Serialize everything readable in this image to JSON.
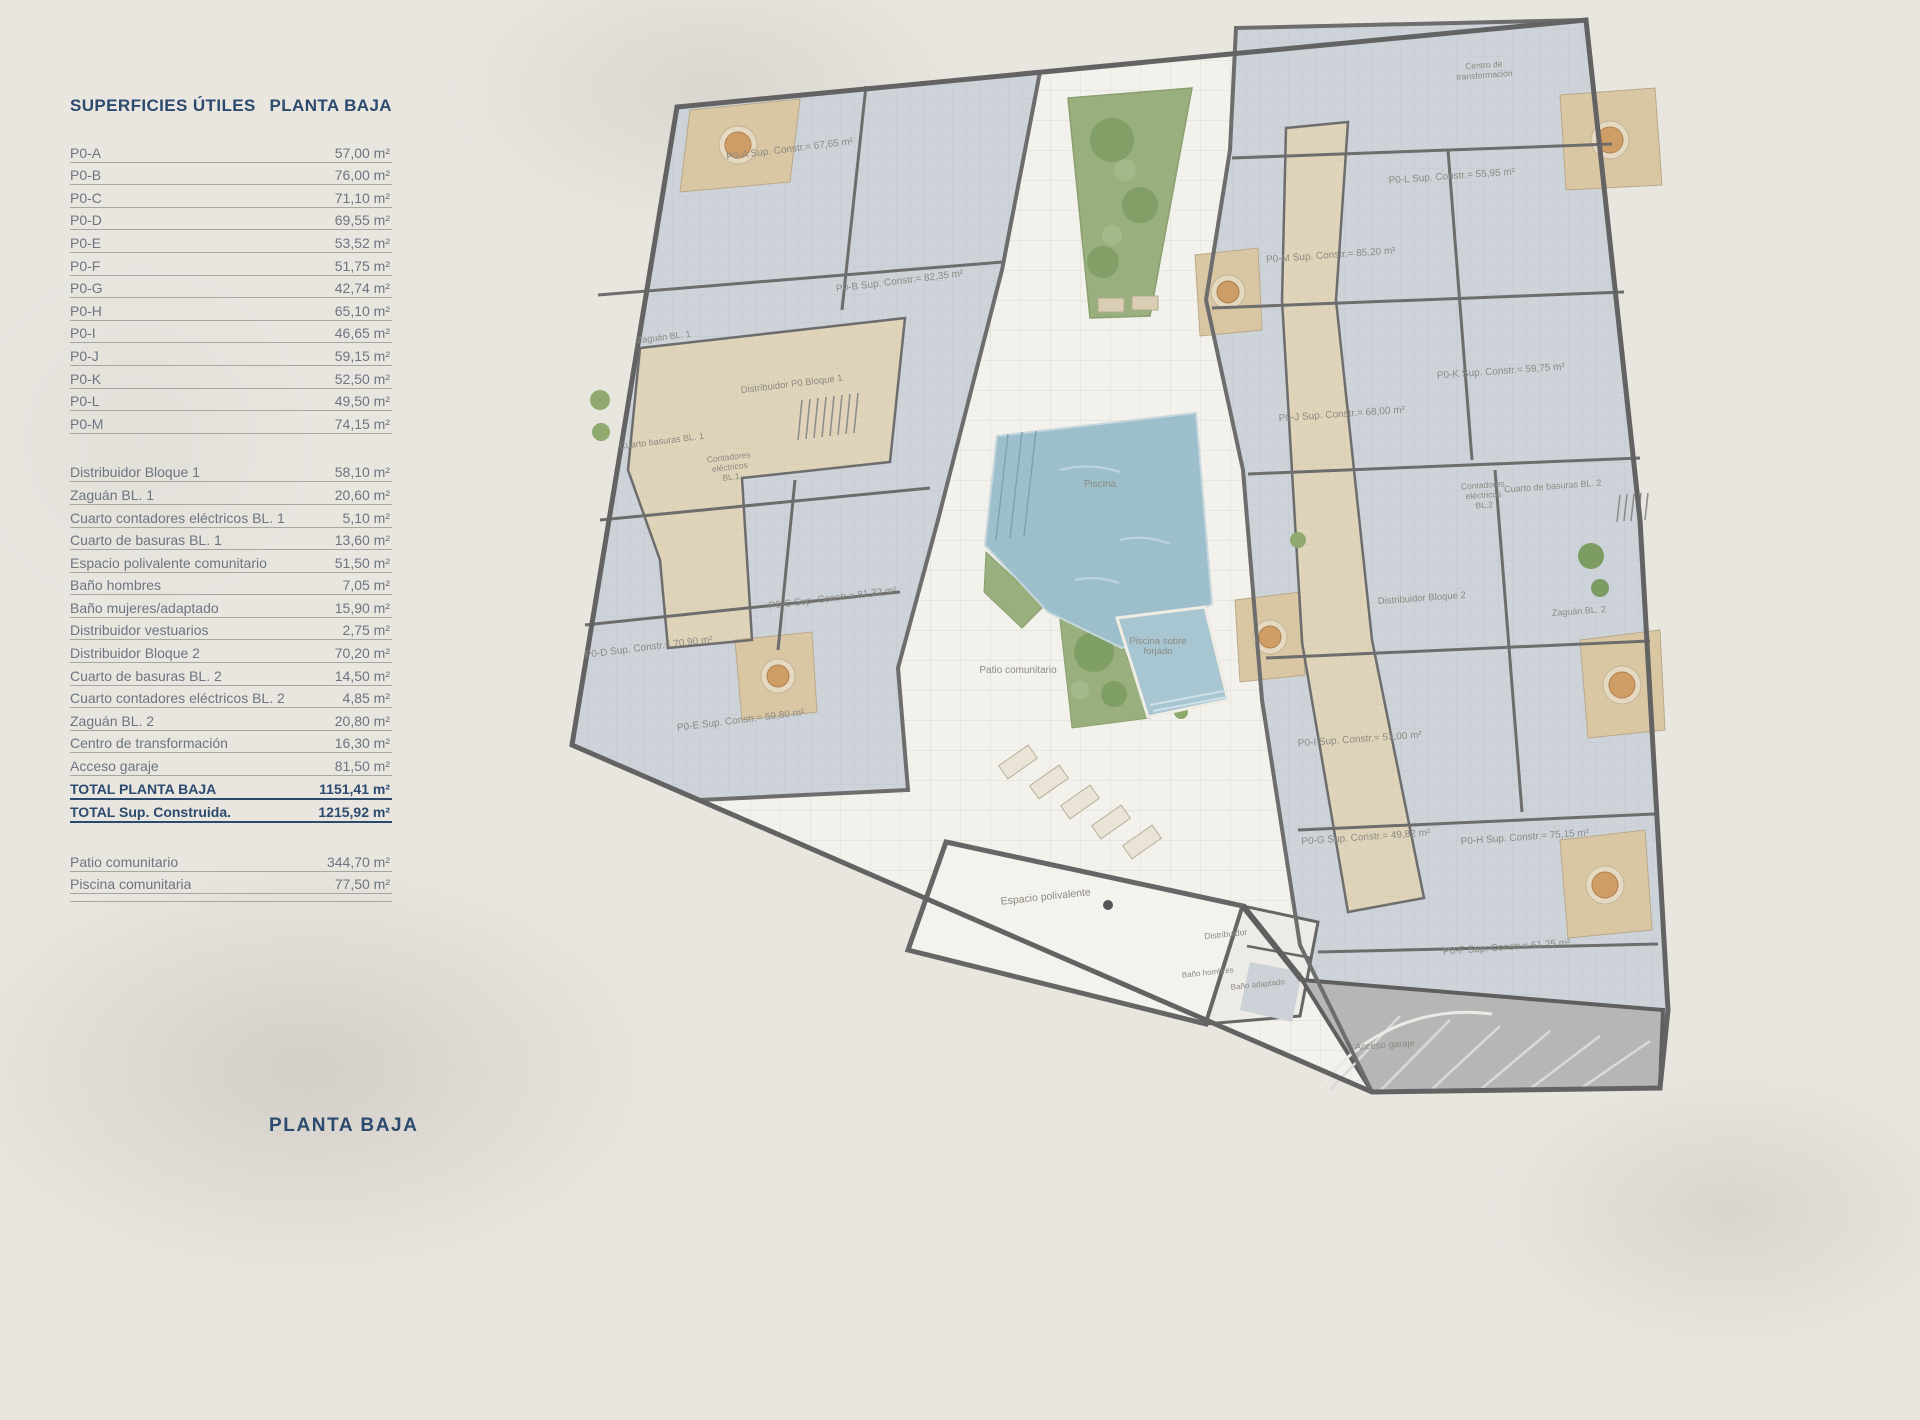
{
  "panel": {
    "title_left": "SUPERFICIES ÚTILES",
    "title_right": "PLANTA BAJA",
    "units": [
      {
        "label": "P0-A",
        "value": "57,00 m²"
      },
      {
        "label": "P0-B",
        "value": "76,00 m²"
      },
      {
        "label": "P0-C",
        "value": "71,10 m²"
      },
      {
        "label": "P0-D",
        "value": "69,55 m²"
      },
      {
        "label": "P0-E",
        "value": "53,52 m²"
      },
      {
        "label": "P0-F",
        "value": "51,75 m²"
      },
      {
        "label": "P0-G",
        "value": "42,74 m²"
      },
      {
        "label": "P0-H",
        "value": "65,10 m²"
      },
      {
        "label": "P0-I",
        "value": "46,65 m²"
      },
      {
        "label": "P0-J",
        "value": "59,15 m²"
      },
      {
        "label": "P0-K",
        "value": "52,50 m²"
      },
      {
        "label": "P0-L",
        "value": "49,50 m²"
      },
      {
        "label": "P0-M",
        "value": "74,15 m²"
      }
    ],
    "common": [
      {
        "label": "Distribuidor Bloque 1",
        "value": "58,10 m²"
      },
      {
        "label": "Zaguán BL. 1",
        "value": "20,60 m²"
      },
      {
        "label": "Cuarto contadores eléctricos BL. 1",
        "value": "5,10 m²"
      },
      {
        "label": "Cuarto de basuras BL. 1",
        "value": "13,60 m²"
      },
      {
        "label": "Espacio polivalente comunitario",
        "value": "51,50 m²"
      },
      {
        "label": "Baño hombres",
        "value": "7,05 m²"
      },
      {
        "label": "Baño mujeres/adaptado",
        "value": "15,90 m²"
      },
      {
        "label": "Distribuidor vestuarios",
        "value": "2,75 m²"
      },
      {
        "label": "Distribuidor Bloque 2",
        "value": "70,20 m²"
      },
      {
        "label": "Cuarto de basuras BL. 2",
        "value": "14,50 m²"
      },
      {
        "label": "Cuarto contadores eléctricos BL. 2",
        "value": "4,85 m²"
      },
      {
        "label": "Zaguán BL. 2",
        "value": "20,80 m²"
      },
      {
        "label": "Centro de transformación",
        "value": "16,30 m²"
      },
      {
        "label": "Acceso garaje",
        "value": "81,50 m²"
      }
    ],
    "totals": [
      {
        "label": "TOTAL PLANTA BAJA",
        "value": "1151,41 m²"
      },
      {
        "label": "TOTAL Sup. Construida.",
        "value": "1215,92 m²"
      }
    ],
    "extras": [
      {
        "label": "Patio comunitario",
        "value": "344,70 m²"
      },
      {
        "label": "Piscina comunitaria",
        "value": "77,50 m²"
      }
    ]
  },
  "footer": {
    "label": "PLANTA BAJA"
  },
  "colors": {
    "accent_navy": "#2c4a6e",
    "row_text": "#6c7580",
    "wall": "#636363",
    "apartment_floor": "#cdd3d9",
    "communal_floor": "#dfd4ba",
    "terrace": "#d9c7a4",
    "pool": "#9dbfcc",
    "garden": "#99af7e",
    "garage": "#b6b6b6",
    "background": "#e9e6e0"
  },
  "plan": {
    "labels": [
      {
        "text": "P0-A Sup. Constr.= 67,65 m²",
        "x": 790,
        "y": 152,
        "rot": -7
      },
      {
        "text": "P0-B Sup. Constr.= 82,35 m²",
        "x": 900,
        "y": 284,
        "rot": -7
      },
      {
        "text": "Zaguán BL. 1",
        "x": 664,
        "y": 340,
        "rot": -7,
        "size": 9
      },
      {
        "text": "Distribuidor P0 Bloque 1",
        "x": 792,
        "y": 387,
        "rot": -7,
        "size": 9.5
      },
      {
        "text": "Cuarto basuras BL. 1",
        "x": 662,
        "y": 444,
        "rot": -7,
        "size": 9
      },
      {
        "lines": [
          "Contadores",
          "eléctricos",
          "BL.1"
        ],
        "x": 729,
        "y": 460,
        "rot": -7,
        "size": 8.5
      },
      {
        "text": "P0-C Sup. Constr.= 81,32 m²",
        "x": 833,
        "y": 601,
        "rot": -7
      },
      {
        "text": "P0-D Sup. Constr.= 70,90 m²",
        "x": 649,
        "y": 650,
        "rot": -7
      },
      {
        "text": "P0-E Sup. Constr.= 59,80 m²",
        "x": 741,
        "y": 723,
        "rot": -7
      },
      {
        "text": "Piscina",
        "x": 1100,
        "y": 487,
        "rot": 0,
        "color": "#7d97a3"
      },
      {
        "lines": [
          "Piscina sobre",
          "forjado"
        ],
        "x": 1158,
        "y": 644,
        "rot": 0,
        "size": 9.5,
        "color": "#7d97a3"
      },
      {
        "text": "Patio comunitario",
        "x": 1018,
        "y": 673,
        "rot": 0,
        "size": 10
      },
      {
        "text": "Espacio polivalente",
        "x": 1046,
        "y": 900,
        "rot": -6,
        "size": 10.5
      },
      {
        "text": "Distribuidor",
        "x": 1226,
        "y": 937,
        "rot": -6,
        "size": 8.5
      },
      {
        "text": "Baño hombres",
        "x": 1208,
        "y": 975,
        "rot": -6,
        "size": 8
      },
      {
        "text": "Baño adaptado",
        "x": 1258,
        "y": 987,
        "rot": -6,
        "size": 8
      },
      {
        "lines": [
          "Centro de",
          "transformación"
        ],
        "x": 1484,
        "y": 68,
        "rot": -4,
        "size": 8.5
      },
      {
        "text": "P0-L Sup. Constr.= 55,95 m²",
        "x": 1452,
        "y": 179,
        "rot": -4
      },
      {
        "text": "P0-M Sup. Constr.= 85,20 m²",
        "x": 1331,
        "y": 258,
        "rot": -4
      },
      {
        "text": "P0-K Sup. Constr.= 59,75 m²",
        "x": 1501,
        "y": 374,
        "rot": -4
      },
      {
        "text": "P0-J Sup. Constr.= 68,00 m²",
        "x": 1342,
        "y": 417,
        "rot": -4
      },
      {
        "text": "Cuarto de basuras BL. 2",
        "x": 1553,
        "y": 489,
        "rot": -4,
        "size": 9
      },
      {
        "lines": [
          "Contadores",
          "eléctricos",
          "BL.2"
        ],
        "x": 1483,
        "y": 488,
        "rot": -4,
        "size": 8.5
      },
      {
        "text": "Distribuidor Bloque 2",
        "x": 1422,
        "y": 601,
        "rot": -4,
        "size": 9.5
      },
      {
        "text": "Zaguán BL. 2",
        "x": 1579,
        "y": 614,
        "rot": -4,
        "size": 9
      },
      {
        "text": "P0-I Sup. Constr.= 53,00 m²",
        "x": 1360,
        "y": 742,
        "rot": -4
      },
      {
        "text": "P0-G Sup. Constr.= 49,82 m²",
        "x": 1366,
        "y": 840,
        "rot": -4
      },
      {
        "text": "P0-H Sup. Constr.= 75,15 m²",
        "x": 1525,
        "y": 840,
        "rot": -4
      },
      {
        "text": "P0-F Sup. Constr.= 61,25 m²",
        "x": 1507,
        "y": 950,
        "rot": -4
      },
      {
        "text": "Acceso garaje",
        "x": 1385,
        "y": 1048,
        "rot": -4,
        "size": 9.5,
        "color": "#6f6f6f"
      }
    ]
  }
}
